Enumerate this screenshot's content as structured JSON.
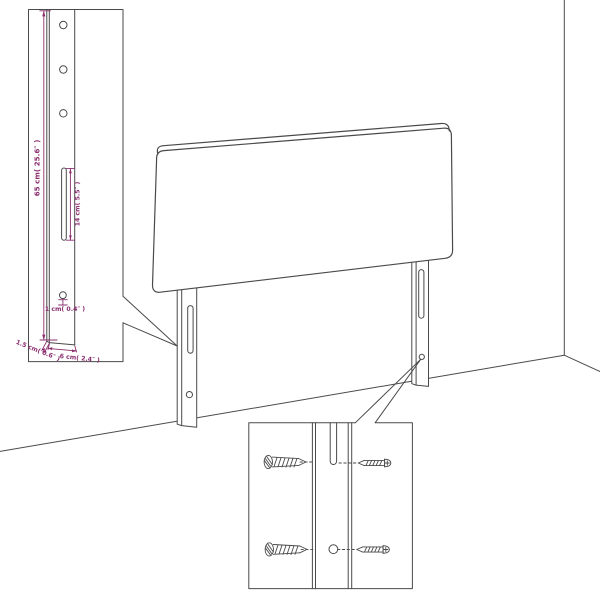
{
  "canvas": {
    "width": 600,
    "height": 600,
    "background": "#ffffff"
  },
  "palette": {
    "ink": "#4a4a4a",
    "accent": "#8b2f6f"
  },
  "post_detail": {
    "dimensions": {
      "height": "65 cm( 25.6″ )",
      "slot_length": "14 cm( 5.5″ )",
      "hole_offset": "1 cm( 0.4″ )",
      "side_thickness": "1.5 cm( 0.6″ )",
      "front_width": "6 cm( 2.4″ )"
    },
    "visible_holes": 3
  },
  "headboard": {
    "legs": 2,
    "slots_per_leg": 1,
    "holes_per_leg": 1
  },
  "screw_detail": {
    "screws": 4,
    "holes": 1,
    "slots": 1
  }
}
